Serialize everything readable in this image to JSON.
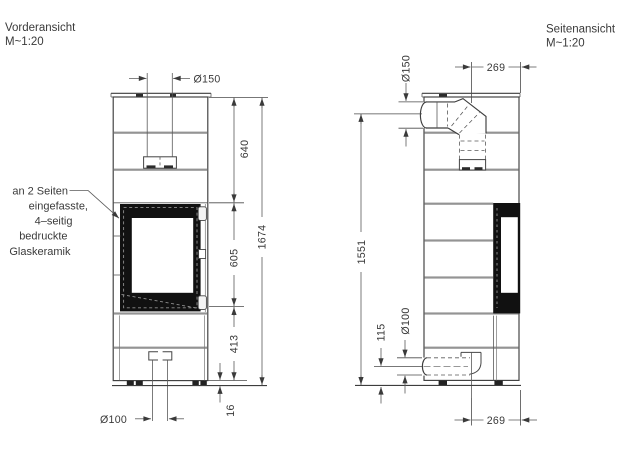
{
  "front_view": {
    "title": "Vorderansicht",
    "scale": "M~1:20",
    "annotation": [
      "an 2 Seiten",
      "eingefasste,",
      "4–seitig",
      "bedruckte",
      "Glaskeramik"
    ],
    "dims": {
      "flue_d": "Ø150",
      "upper": "640",
      "glass": "605",
      "base": "413",
      "total": "1674",
      "gap": "16",
      "air_d": "Ø100"
    }
  },
  "side_view": {
    "title": "Seitenansicht",
    "scale": "M~1:20",
    "dims": {
      "flue_d": "Ø150",
      "flue_off": "269",
      "axis_h": "1551",
      "air_d": "Ø100",
      "air_h": "115",
      "air_off": "269"
    }
  },
  "colors": {
    "line": "#3d3d3d",
    "divider": "#949494",
    "glass": "#111111",
    "text": "#3a3a3a"
  }
}
